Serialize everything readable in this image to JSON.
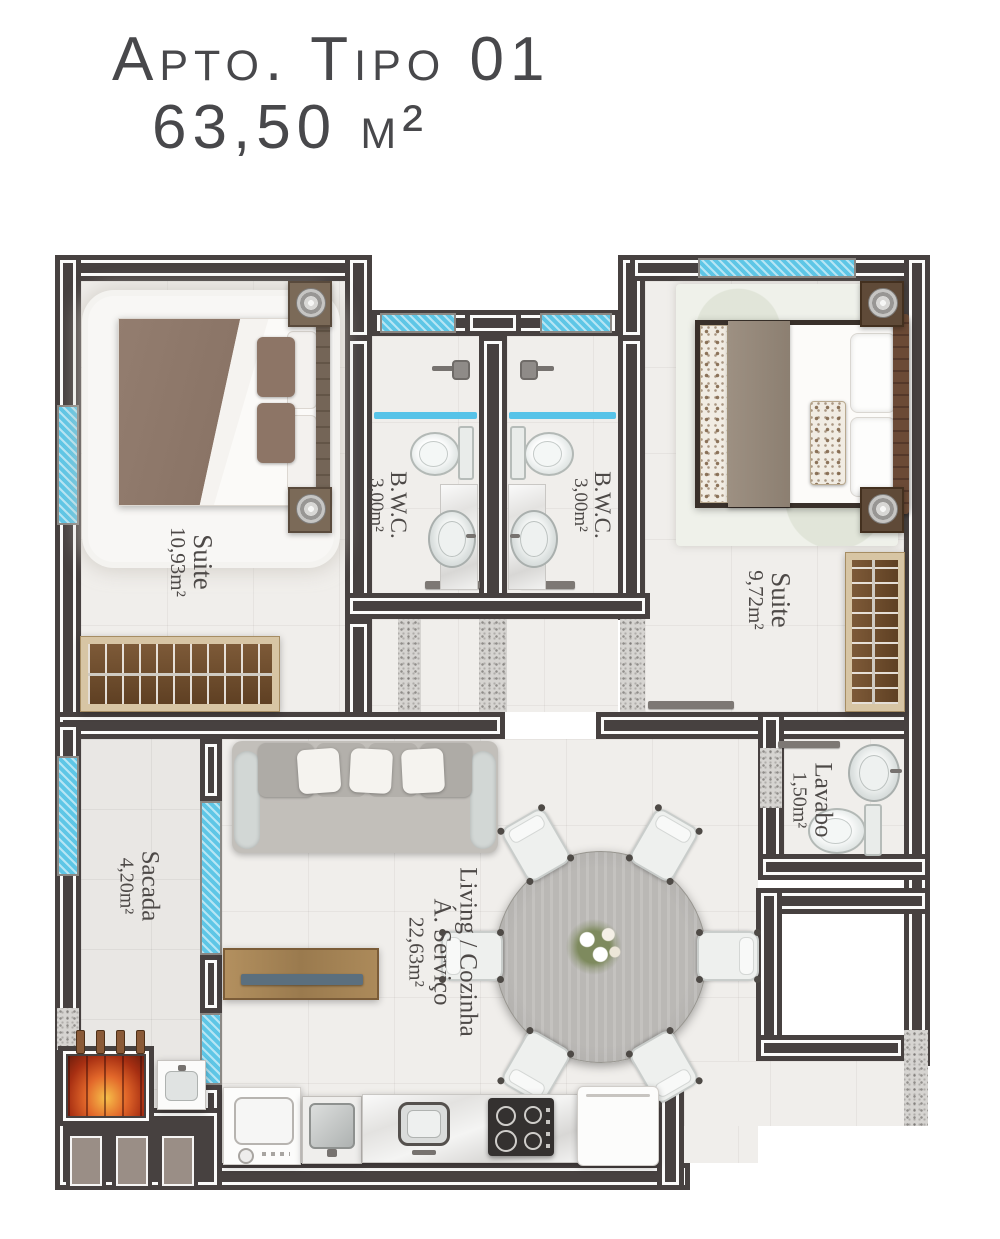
{
  "title": {
    "line1": "Apto. Tipo 01",
    "line2": "63,50 m²"
  },
  "rooms": {
    "suite_left": {
      "name": "Suite",
      "area": "10,93m²"
    },
    "bwc_left": {
      "name": "B.W.C.",
      "area": "3,00m²"
    },
    "bwc_right": {
      "name": "B.W.C.",
      "area": "3,00m²"
    },
    "suite_right": {
      "name": "Suite",
      "area": "9,72m²"
    },
    "lavabo": {
      "name": "Lavabo",
      "area": "1,50m²"
    },
    "sacada": {
      "name": "Sacada",
      "area": "4,20m²"
    },
    "living": {
      "name": "Living / Cozinha",
      "name2": "Á. Serviço",
      "area": "22,63m²"
    }
  },
  "colors": {
    "wall": "#474140",
    "window_glass": "#5ec6e6",
    "floor_tile": "#f0eeeb",
    "wood": "#9a7a4e",
    "duvet": "#8b7468",
    "fire": "#e2672a",
    "label_text": "#4d4947"
  }
}
